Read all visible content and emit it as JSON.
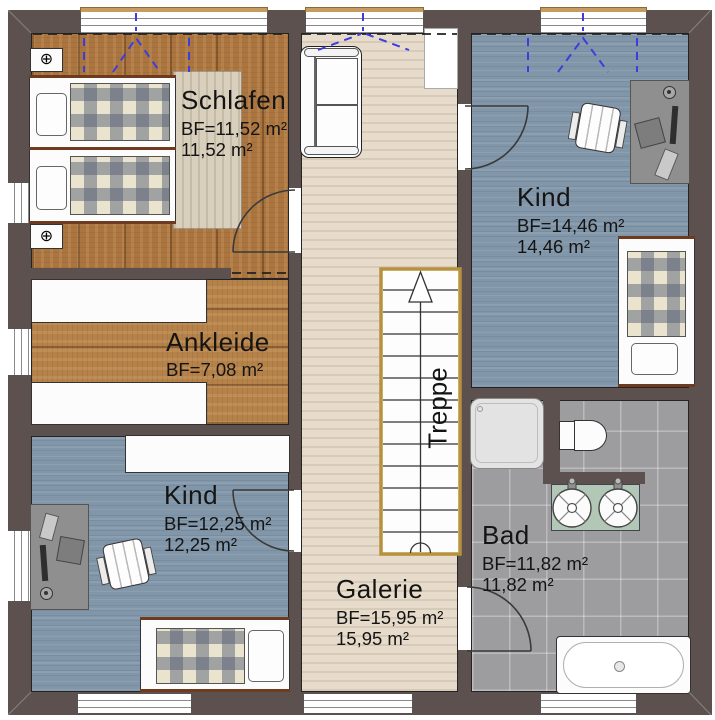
{
  "plan": {
    "title": "Obergeschoss Grundriss",
    "rooms": [
      {
        "id": "schlafen",
        "name": "Schlafen",
        "bf": "BF=11,52 m²",
        "area": "11,52 m²"
      },
      {
        "id": "ankleide",
        "name": "Ankleide",
        "bf": "BF=7,08 m²",
        "area": ""
      },
      {
        "id": "kind_top_right",
        "name": "Kind",
        "bf": "BF=14,46 m²",
        "area": "14,46 m²"
      },
      {
        "id": "kind_bottom_left",
        "name": "Kind",
        "bf": "BF=12,25 m²",
        "area": "12,25 m²"
      },
      {
        "id": "galerie",
        "name": "Galerie",
        "bf": "BF=15,95 m²",
        "area": "15,95 m²"
      },
      {
        "id": "bad",
        "name": "Bad",
        "bf": "BF=11,82 m²",
        "area": "11,82 m²"
      }
    ],
    "stairs": {
      "label": "Treppe"
    },
    "icons": {
      "lamp": "⊕"
    },
    "colors": {
      "wall": "#5c514e",
      "wood": "#ab7540",
      "wood2": "#b5824a",
      "pale": "#e7dccc",
      "blue": "#8196a9",
      "tile": "#9d9da0",
      "gold": "#b8913d",
      "blue_dash": "#3d3dde",
      "counter": "#b2c7b5",
      "rug": "#d9cfbd"
    }
  }
}
